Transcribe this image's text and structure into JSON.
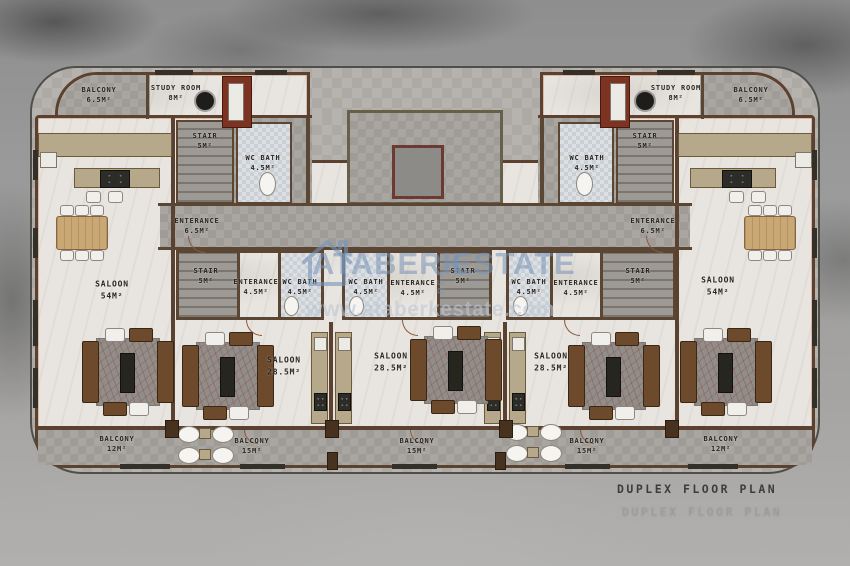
{
  "title": {
    "text": "DUPLEX FLOOR PLAN"
  },
  "watermark": {
    "logo": "house-icon",
    "brand": "ATABERK",
    "real": "REAL",
    "estate": "ESTATE",
    "url": "www.ataberkestate.com",
    "color": "#7694b8"
  },
  "units": {
    "left_corner": {
      "balcony_top": "BALCONY\n6.5M²",
      "study_room": "STUDY ROOM\n8M²",
      "stair": "STAIR\n5M²",
      "wc_bath": "WC BATH\n4.5M²",
      "entrance": "ENTERANCE\n6.5M²",
      "saloon": "SALOON\n54M²",
      "balcony_bottom": "BALCONY\n12M²"
    },
    "right_corner": {
      "balcony_top": "BALCONY\n6.5M²",
      "study_room": "STUDY ROOM\n8M²",
      "stair": "STAIR\n5M²",
      "wc_bath": "WC BATH\n4.5M²",
      "entrance": "ENTERANCE\n6.5M²",
      "saloon": "SALOON\n54M²",
      "balcony_bottom": "BALCONY\n12M²"
    },
    "middle_left": {
      "stair": "STAIR\n5M²",
      "entrance": "ENTERANCE\n4.5M²",
      "wc_bath": "WC BATH\n4.5M²",
      "saloon": "SALOON\n28.5M²",
      "balcony": "BALCONY\n15M²"
    },
    "middle_center": {
      "stair": "STAIR\n5M²",
      "entrance": "ENTERANCE\n4.5M²",
      "wc_bath": "WC BATH\n4.5M²",
      "saloon": "SALOON\n28.5M²",
      "balcony": "BALCONY\n15M²"
    },
    "middle_right": {
      "stair": "STAIR\n5M²",
      "entrance": "ENTERANCE\n4.5M²",
      "wc_bath": "WC BATH\n4.5M²",
      "saloon": "SALOON\n28.5M²",
      "balcony": "BALCONY\n15M²"
    }
  },
  "colors": {
    "wall": "#5a4130",
    "wall_accent": "#cf8560",
    "terrace": "#b6b3ae",
    "floor": "#e8e5e0",
    "tile": "#a9a6a1",
    "study_floor": "#7c3322",
    "background": "#9c9c9c",
    "title_text": "#3c3c3a"
  }
}
